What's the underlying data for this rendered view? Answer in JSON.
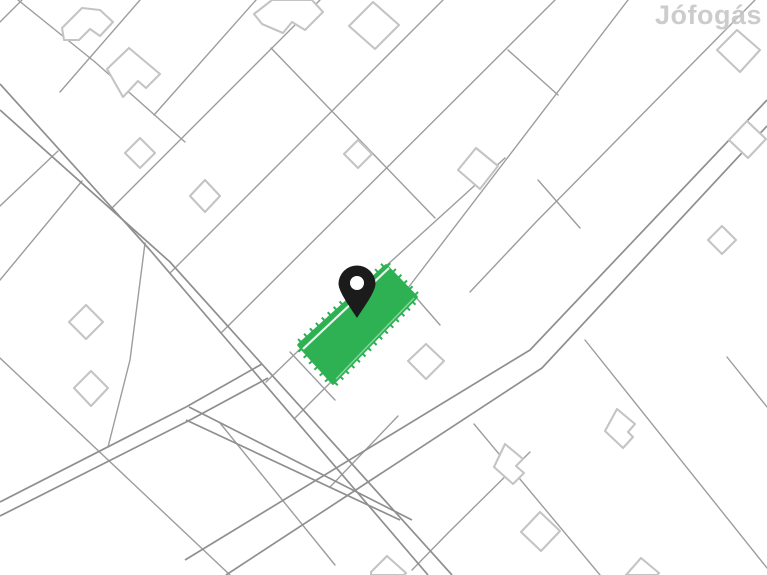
{
  "watermark": {
    "text": "Jófogás",
    "color": "#c4c4c4"
  },
  "colors": {
    "background": "#ffffff",
    "parcel_line": "#9d9d9d",
    "road_line": "#8f8f8f",
    "building_outline": "#c4c4c4",
    "building_fill": "#ffffff",
    "highlight_green": "#2db152",
    "overlay_line": "#ffffff",
    "pin_color": "#1b1b1b",
    "pin_hole": "#ffffff"
  },
  "map": {
    "width": 767,
    "height": 575,
    "roads": [
      {
        "name": "main-road-nw-se",
        "edges": [
          [
            [
              0,
              84
            ],
            [
              150,
              250
            ],
            [
              428,
              575
            ]
          ],
          [
            [
              0,
              110
            ],
            [
              170,
              262
            ],
            [
              452,
              575
            ]
          ]
        ]
      },
      {
        "name": "cross-road-ne-sw",
        "edges": [
          [
            [
              767,
              100
            ],
            [
              530,
              350
            ],
            [
              185,
              560
            ]
          ],
          [
            [
              767,
              126
            ],
            [
              542,
              368
            ],
            [
              226,
              575
            ]
          ]
        ]
      },
      {
        "name": "branch-road-west",
        "edges": [
          [
            [
              262,
              364
            ],
            [
              186,
              407
            ],
            [
              0,
              502
            ]
          ],
          [
            [
              268,
              378
            ],
            [
              192,
              419
            ],
            [
              0,
              516
            ]
          ]
        ]
      },
      {
        "name": "frontage-road",
        "edges": [
          [
            [
              189,
              407
            ],
            [
              412,
              520
            ]
          ],
          [
            [
              186,
              420
            ],
            [
              400,
              520
            ]
          ]
        ]
      }
    ],
    "parcel_lines": [
      [
        [
          22,
          0
        ],
        [
          0,
          22
        ]
      ],
      [
        [
          140,
          0
        ],
        [
          60,
          92
        ]
      ],
      [
        [
          256,
          0
        ],
        [
          154,
          115
        ]
      ],
      [
        [
          18,
          0
        ],
        [
          95,
          62
        ]
      ],
      [
        [
          95,
          62
        ],
        [
          185,
          142
        ]
      ],
      [
        [
          0,
          206
        ],
        [
          58,
          151
        ]
      ],
      [
        [
          0,
          280
        ],
        [
          82,
          181
        ]
      ],
      [
        [
          320,
          0
        ],
        [
          112,
          208
        ]
      ],
      [
        [
          443,
          0
        ],
        [
          170,
          273
        ]
      ],
      [
        [
          555,
          0
        ],
        [
          221,
          333
        ]
      ],
      [
        [
          628,
          0
        ],
        [
          408,
          288
        ]
      ],
      [
        [
          406,
          286
        ],
        [
          440,
          325
        ]
      ],
      [
        [
          505,
          158
        ],
        [
          386,
          266
        ],
        [
          266,
          382
        ]
      ],
      [
        [
          416,
          297
        ],
        [
          294,
          419
        ]
      ],
      [
        [
          755,
          0
        ],
        [
          536,
          222
        ],
        [
          470,
          292
        ]
      ],
      [
        [
          271,
          48
        ],
        [
          435,
          218
        ]
      ],
      [
        [
          508,
          50
        ],
        [
          558,
          95
        ]
      ],
      [
        [
          538,
          180
        ],
        [
          580,
          228
        ]
      ],
      [
        [
          290,
          352
        ],
        [
          335,
          400
        ]
      ],
      [
        [
          145,
          243
        ],
        [
          130,
          360
        ],
        [
          108,
          447
        ]
      ],
      [
        [
          0,
          358
        ],
        [
          230,
          575
        ]
      ],
      [
        [
          220,
          423
        ],
        [
          335,
          565
        ]
      ],
      [
        [
          398,
          416
        ],
        [
          330,
          487
        ]
      ],
      [
        [
          530,
          452
        ],
        [
          448,
          533
        ],
        [
          412,
          570
        ]
      ],
      [
        [
          585,
          340
        ],
        [
          767,
          568
        ]
      ],
      [
        [
          727,
          357
        ],
        [
          767,
          407
        ]
      ],
      [
        [
          474,
          424
        ],
        [
          600,
          575
        ]
      ]
    ],
    "buildings": [
      [
        [
          62,
          28
        ],
        [
          82,
          8
        ],
        [
          100,
          10
        ],
        [
          113,
          22
        ],
        [
          100,
          36
        ],
        [
          90,
          29
        ],
        [
          79,
          40
        ],
        [
          64,
          40
        ]
      ],
      [
        [
          107,
          69
        ],
        [
          129,
          48
        ],
        [
          160,
          74
        ],
        [
          146,
          88
        ],
        [
          138,
          81
        ],
        [
          123,
          97
        ]
      ],
      [
        [
          254,
          14
        ],
        [
          272,
          0
        ],
        [
          312,
          0
        ],
        [
          323,
          12
        ],
        [
          305,
          30
        ],
        [
          292,
          22
        ],
        [
          283,
          33
        ],
        [
          262,
          24
        ]
      ],
      [
        [
          373,
          2
        ],
        [
          399,
          25
        ],
        [
          375,
          49
        ],
        [
          349,
          26
        ]
      ],
      [
        [
          358,
          140
        ],
        [
          372,
          154
        ],
        [
          358,
          168
        ],
        [
          344,
          154
        ]
      ],
      [
        [
          476,
          148
        ],
        [
          498,
          166
        ],
        [
          480,
          189
        ],
        [
          458,
          170
        ]
      ],
      [
        [
          205,
          180
        ],
        [
          220,
          196
        ],
        [
          205,
          212
        ],
        [
          190,
          196
        ]
      ],
      [
        [
          140,
          138
        ],
        [
          155,
          153
        ],
        [
          140,
          168
        ],
        [
          125,
          153
        ]
      ],
      [
        [
          86,
          305
        ],
        [
          103,
          322
        ],
        [
          86,
          339
        ],
        [
          69,
          322
        ]
      ],
      [
        [
          91,
          371
        ],
        [
          108,
          388
        ],
        [
          91,
          406
        ],
        [
          74,
          388
        ]
      ],
      [
        [
          426,
          344
        ],
        [
          444,
          361
        ],
        [
          426,
          379
        ],
        [
          408,
          361
        ]
      ],
      [
        [
          722,
          226
        ],
        [
          736,
          240
        ],
        [
          722,
          254
        ],
        [
          708,
          240
        ]
      ],
      [
        [
          747,
          121
        ],
        [
          766,
          139
        ],
        [
          748,
          158
        ],
        [
          729,
          140
        ]
      ],
      [
        [
          737,
          30
        ],
        [
          760,
          50
        ],
        [
          740,
          72
        ],
        [
          717,
          50
        ]
      ],
      [
        [
          617,
          409
        ],
        [
          635,
          424
        ],
        [
          628,
          432
        ],
        [
          633,
          437
        ],
        [
          623,
          448
        ],
        [
          605,
          431
        ]
      ],
      [
        [
          505,
          444
        ],
        [
          523,
          459
        ],
        [
          516,
          466
        ],
        [
          524,
          473
        ],
        [
          513,
          484
        ],
        [
          494,
          467
        ]
      ],
      [
        [
          540,
          512
        ],
        [
          560,
          531
        ],
        [
          541,
          551
        ],
        [
          521,
          532
        ]
      ],
      [
        [
          387,
          556
        ],
        [
          406,
          573
        ],
        [
          404,
          575
        ],
        [
          371,
          575
        ],
        [
          371,
          572
        ]
      ],
      [
        [
          641,
          558
        ],
        [
          659,
          573
        ],
        [
          657,
          575
        ],
        [
          626,
          575
        ]
      ]
    ],
    "highlight_parcel": {
      "polygon": [
        [
          386,
          266
        ],
        [
          416,
          297
        ],
        [
          333,
          383
        ],
        [
          299,
          345
        ]
      ],
      "inner_lines": [
        [
          [
            303,
            349
          ],
          [
            389,
            268
          ]
        ],
        [
          [
            336,
            379
          ],
          [
            414,
            298
          ]
        ]
      ]
    },
    "pin": {
      "cx": 357,
      "cy": 284,
      "head_r": 18.5,
      "tip_y": 318,
      "hole_r": 7
    }
  }
}
